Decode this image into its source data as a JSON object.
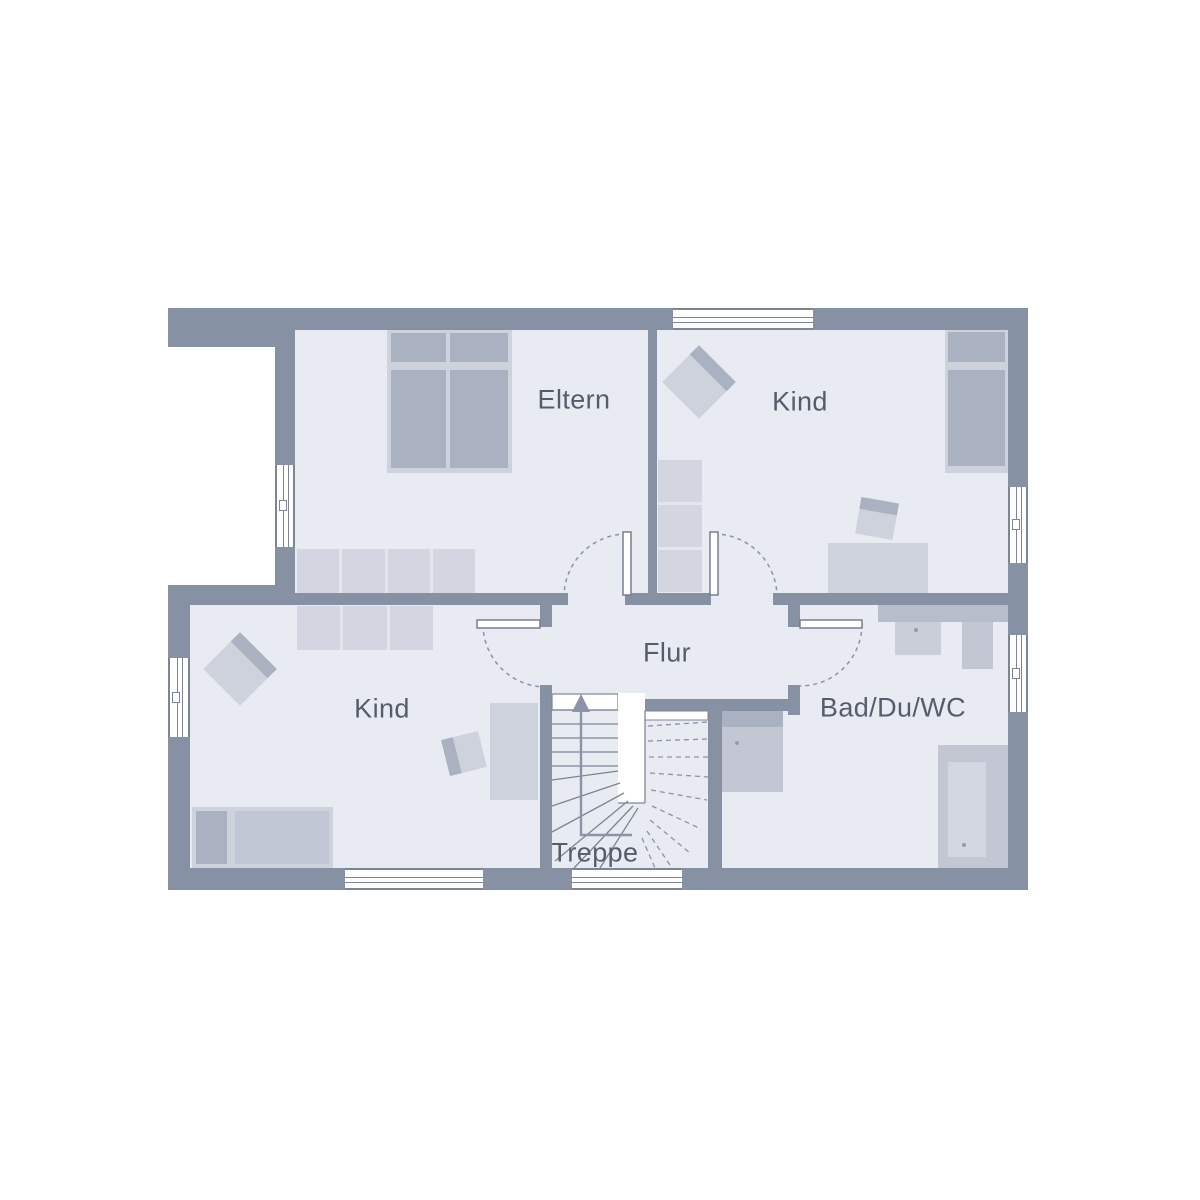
{
  "title": "Obergeschoss Grundriss",
  "rooms": [
    {
      "id": "eltern",
      "label": "Eltern"
    },
    {
      "id": "kind_top",
      "label": "Kind"
    },
    {
      "id": "kind_bottom",
      "label": "Kind"
    },
    {
      "id": "flur",
      "label": "Flur"
    },
    {
      "id": "bad",
      "label": "Bad/Du/WC"
    },
    {
      "id": "treppe",
      "label": "Treppe"
    }
  ],
  "colors": {
    "wall": "#8791a4",
    "floor": "#e8ebf1",
    "outside": "#ffffff",
    "line": "#7c8598",
    "text": "#555c6c",
    "furn_dark": "#aab1c1",
    "furn_light": "#cdd2dc",
    "closet": "#d3d6e0",
    "closet_gap": "#e3e6ec",
    "appliance": "#c2c7d3",
    "counter": "#b6bdcb",
    "sink": "#c9ced9",
    "tub_inner": "#d3d7e1",
    "mattress_lt": "#c0c6d3",
    "dot": "#939bad",
    "arc": "#8a93a7",
    "leaf": "#6e7689"
  }
}
